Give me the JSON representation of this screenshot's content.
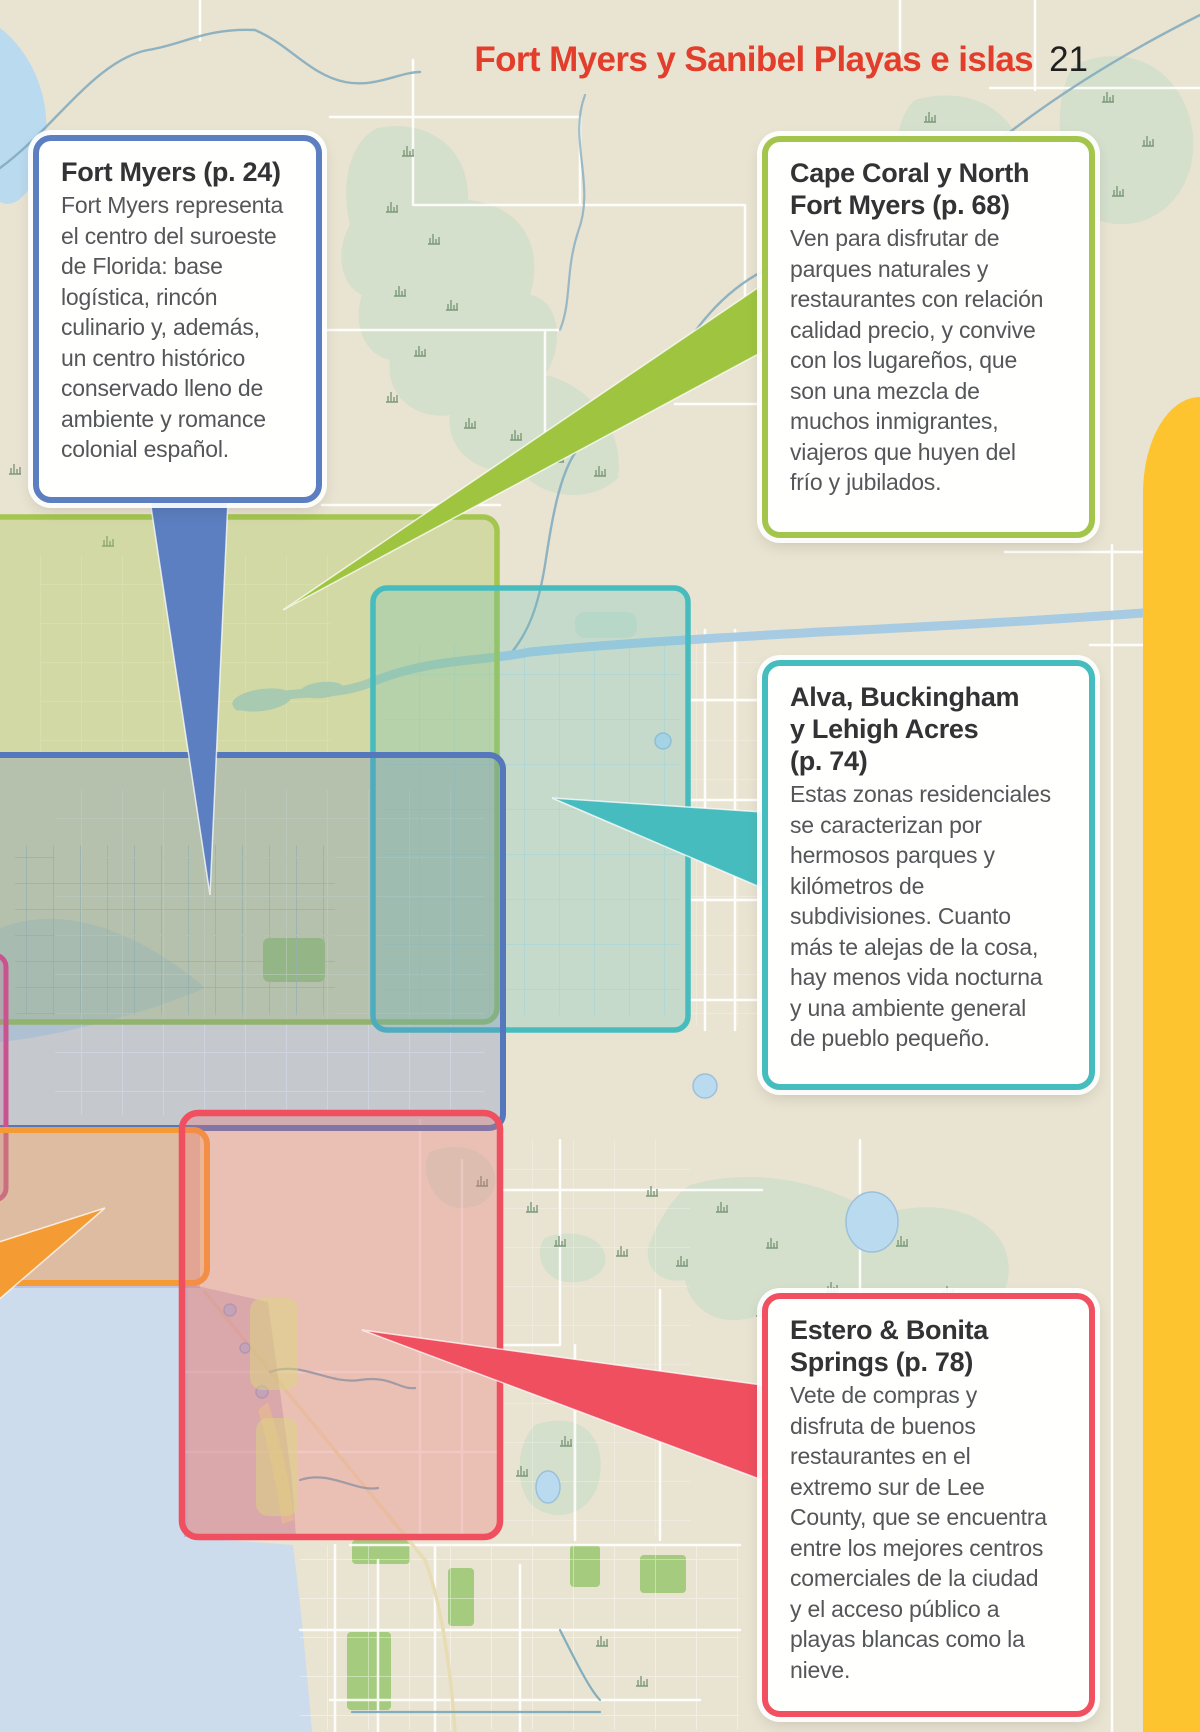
{
  "page": {
    "header_title": "Fort Myers y Sanibel Playas e islas",
    "page_number": "21",
    "header_color": "#e23e2b"
  },
  "callouts": {
    "fort_myers": {
      "border_color": "#5b7fc0",
      "title_lines": [
        "Fort Myers (p. 24)"
      ],
      "body_lines": [
        "Fort Myers representa",
        "el centro del suroeste",
        "de Florida: base",
        "logística, rincón",
        "culinario y, además,",
        "un centro histórico",
        "conservado lleno de",
        "ambiente y romance",
        "colonial español."
      ]
    },
    "cape_coral": {
      "border_color": "#a3c54b",
      "title_lines": [
        "Cape Coral y North",
        "Fort Myers (p. 68)"
      ],
      "body_lines": [
        "Ven para disfrutar de",
        "parques naturales y",
        "restaurantes con relación",
        "calidad precio, y convive",
        "con los lugareños, que",
        "son una mezcla de",
        "muchos inmigrantes,",
        "viajeros que huyen del",
        "frío y jubilados."
      ]
    },
    "alva": {
      "border_color": "#45bcbe",
      "title_lines": [
        "Alva, Buckingham",
        "y Lehigh Acres",
        "(p. 74)"
      ],
      "body_lines": [
        "Estas zonas residenciales",
        "se caracterizan por",
        "hermosos parques y",
        "kilómetros de",
        "subdivisiones. Cuanto",
        "más te alejas de la cosa,",
        "hay menos vida nocturna",
        "y una ambiente general",
        "de pueblo pequeño."
      ]
    },
    "estero": {
      "border_color": "#f0505f",
      "title_lines": [
        "Estero & Bonita",
        "Springs (p. 78)"
      ],
      "body_lines": [
        "Vete de compras y",
        "disfruta de buenos",
        "restaurantes en el",
        "extremo sur de Lee",
        "County, que se encuentra",
        "entre los mejores centros",
        "comerciales de la ciudad",
        "y el acceso público a",
        "playas blancas como la",
        "nieve."
      ]
    }
  },
  "map": {
    "side_panel_color": "#fdc42f",
    "land_color": "#e9e3d1",
    "water_color": "#ccdcec",
    "regions": [
      {
        "id": "cape-coral-north-region",
        "color": "#a4c64f"
      },
      {
        "id": "alva-buckingham-lehigh-region",
        "color": "#47bcbe"
      },
      {
        "id": "fort-myers-region",
        "color": "#5577bb"
      },
      {
        "id": "off-page-west-region",
        "color": "#c9538f"
      },
      {
        "id": "off-page-southwest-region",
        "color": "#f49b33"
      },
      {
        "id": "estero-bonita-region",
        "color": "#ef4f5f"
      }
    ],
    "pointers": [
      {
        "id": "fort-myers-pointer",
        "color": "#5b7fc0"
      },
      {
        "id": "cape-coral-pointer",
        "color": "#9fc540"
      },
      {
        "id": "alva-pointer",
        "color": "#47bcbe"
      },
      {
        "id": "estero-pointer",
        "color": "#ef4f5f"
      },
      {
        "id": "southwest-pointer",
        "color": "#f49b33"
      }
    ]
  }
}
